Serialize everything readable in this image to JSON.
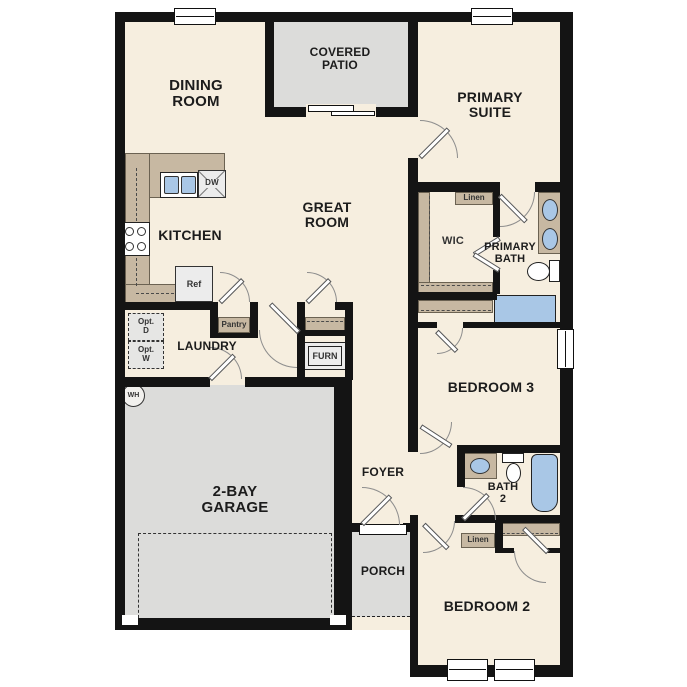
{
  "plan_type": "single-story floor plan",
  "rooms": {
    "dining": {
      "line1": "DINING",
      "line2": "ROOM"
    },
    "covered_patio": {
      "line1": "COVERED",
      "line2": "PATIO"
    },
    "primary_suite": {
      "line1": "PRIMARY",
      "line2": "SUITE"
    },
    "great_room": {
      "line1": "GREAT",
      "line2": "ROOM"
    },
    "kitchen": {
      "label": "KITCHEN"
    },
    "laundry": {
      "label": "LAUNDRY"
    },
    "wic": {
      "label": "WIC"
    },
    "primary_bath": {
      "line1": "PRIMARY",
      "line2": "BATH"
    },
    "bedroom3": {
      "label": "BEDROOM 3"
    },
    "foyer": {
      "label": "FOYER"
    },
    "bath2": {
      "line1": "BATH",
      "line2": "2"
    },
    "garage": {
      "line1": "2-BAY",
      "line2": "GARAGE"
    },
    "porch": {
      "label": "PORCH"
    },
    "bedroom2": {
      "label": "BEDROOM 2"
    }
  },
  "features": {
    "linen_primary": "Linen",
    "linen_hall": "Linen",
    "pantry": "Pantry",
    "furnace": "FURN",
    "refrigerator": "Ref",
    "dishwasher": "DW",
    "water_heater": "WH",
    "opt_dryer_line1": "Opt.",
    "opt_dryer_line2": "D",
    "opt_washer_line1": "Opt.",
    "opt_washer_line2": "W"
  },
  "colors": {
    "wall": "#141414",
    "floor": "#f6eedf",
    "exterior_area": "#dcdcda",
    "counter": "#c7b8a2",
    "water_fixture": "#a9c7e6",
    "appliance": "#ececec"
  }
}
